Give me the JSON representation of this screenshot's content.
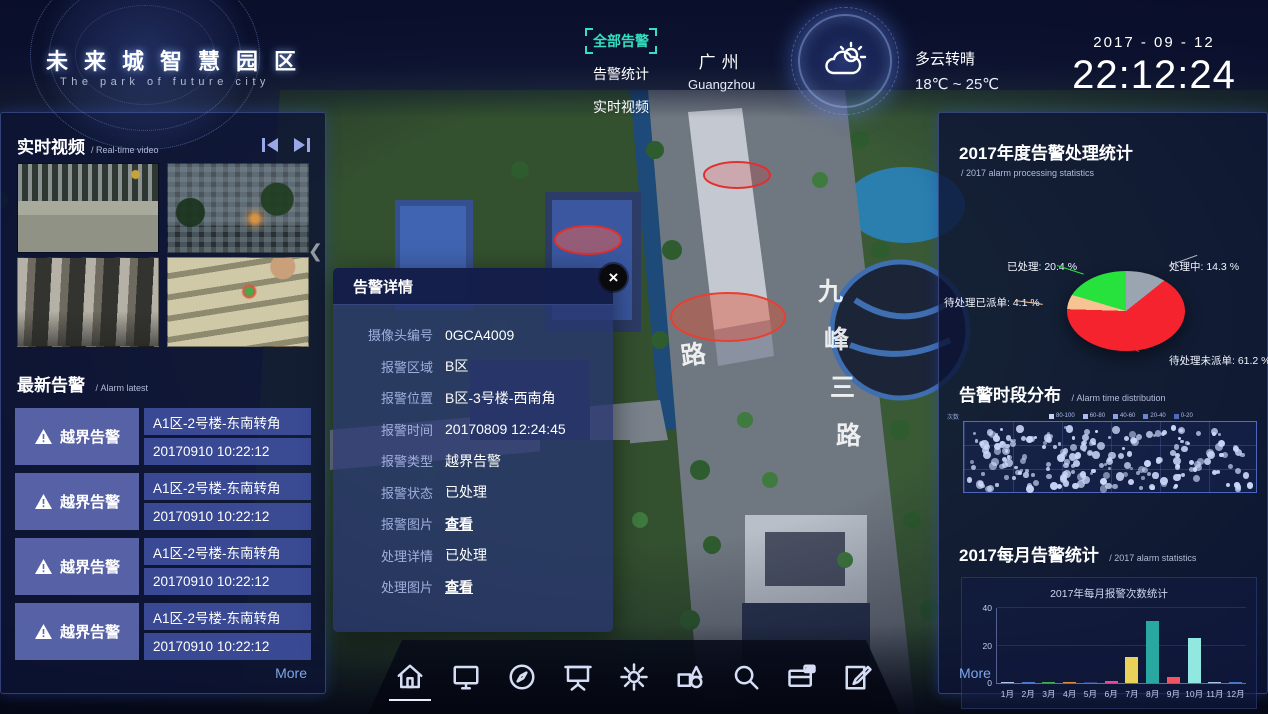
{
  "header": {
    "logo_title": "未来城智慧园区",
    "logo_subtitle": "The park of future city",
    "nav": [
      {
        "label": "全部告警",
        "active": true
      },
      {
        "label": "告警统计",
        "active": false
      },
      {
        "label": "实时视频",
        "active": false
      }
    ],
    "city_cn": "广州",
    "city_en": "Guangzhou",
    "weather_desc": "多云转晴",
    "weather_temp": "18℃ ~ 25℃",
    "date": "2017 - 09 - 12",
    "time": "22:12:24"
  },
  "left_panel": {
    "video_title": "实时视频",
    "video_subtitle": "/ Real-time video",
    "videos": [
      "street-crosswalk",
      "building-dusk",
      "lobby-interior",
      "stairs-closeup"
    ],
    "alarm_title": "最新告警",
    "alarm_subtitle": "/ Alarm latest",
    "alarms": [
      {
        "type": "越界告警",
        "location": "A1区-2号楼-东南转角",
        "time": "20170910 10:22:12"
      },
      {
        "type": "越界告警",
        "location": "A1区-2号楼-东南转角",
        "time": "20170910 10:22:12"
      },
      {
        "type": "越界告警",
        "location": "A1区-2号楼-东南转角",
        "time": "20170910 10:22:12"
      },
      {
        "type": "越界告警",
        "location": "A1区-2号楼-东南转角",
        "time": "20170910 10:22:12"
      }
    ],
    "more_label": "More"
  },
  "popup": {
    "title": "告警详情",
    "close_glyph": "×",
    "rows": [
      {
        "label": "摄像头编号",
        "value": "0GCA4009",
        "link": false
      },
      {
        "label": "报警区域",
        "value": "B区",
        "link": false
      },
      {
        "label": "报警位置",
        "value": "B区-3号楼-西南角",
        "link": false
      },
      {
        "label": "报警时间",
        "value": "20170809 12:24:45",
        "link": false
      },
      {
        "label": "报警类型",
        "value": "越界告警",
        "link": false
      },
      {
        "label": "报警状态",
        "value": "已处理",
        "link": false
      },
      {
        "label": "报警图片",
        "value": "查看",
        "link": true
      },
      {
        "label": "处理详情",
        "value": "已处理",
        "link": false
      },
      {
        "label": "处理图片",
        "value": "查看",
        "link": true
      }
    ]
  },
  "right_panel": {
    "more_label": "More"
  },
  "chart_data": [
    {
      "type": "pie",
      "title": "2017年度告警处理统计",
      "subtitle": "/ 2017 alarm processing statistics",
      "start": "top",
      "direction": "clockwise",
      "label_format": "{label}: {value} %",
      "slices": [
        {
          "label": "处理中",
          "value": 14.3,
          "color": "#9aa5b1",
          "css": "doing"
        },
        {
          "label": "待处理未派单",
          "value": 61.2,
          "color": "#f5232e",
          "css": "unsent"
        },
        {
          "label": "待处理已派单",
          "value": 4.1,
          "color": "#f8c393",
          "css": "sent"
        },
        {
          "label": "已处理",
          "value": 20.4,
          "color": "#27e23c",
          "css": "done"
        }
      ]
    },
    {
      "type": "scatter",
      "title": "告警时段分布",
      "subtitle": "/ Alarm time distribution",
      "axis_label": "次数",
      "legend": [
        {
          "label": "80-100",
          "color": "#c6d2f8"
        },
        {
          "label": "60-80",
          "color": "#a9bbf0"
        },
        {
          "label": "40-60",
          "color": "#8ba1e4"
        },
        {
          "label": "20-40",
          "color": "#6d86d4"
        },
        {
          "label": "0-20",
          "color": "#5069ba"
        }
      ],
      "appearance": "dense random dot field over 6x3 grid",
      "generator": {
        "seed": 20170912,
        "count": 215
      }
    },
    {
      "type": "bar",
      "title": "2017每月告警统计",
      "subtitle": "/ 2017 alarm statistics",
      "inner_title": "2017年每月报警次数统计",
      "categories": [
        "1月",
        "2月",
        "3月",
        "4月",
        "5月",
        "6月",
        "7月",
        "8月",
        "9月",
        "10月",
        "11月",
        "12月"
      ],
      "values": [
        0.6,
        0.6,
        0.7,
        0.7,
        0.6,
        1,
        14,
        33,
        3,
        24,
        0.6,
        0.3
      ],
      "colors": [
        "#aac4e8",
        "#4a78c8",
        "#3fae4a",
        "#e08a3c",
        "#2a3f7a",
        "#e84a9a",
        "#e8d25a",
        "#28a8a0",
        "#f05560",
        "#90e8e0",
        "#aac4e8",
        "#4a78c8"
      ],
      "ylim": [
        0,
        40
      ],
      "yticks": [
        0,
        20,
        40
      ]
    }
  ],
  "map": {
    "road_label_main": "九峰三路",
    "road_label_side": "路",
    "alarm_zone_count": 3
  },
  "toolbar": {
    "icons": [
      "home",
      "monitor",
      "compass",
      "projection-screen",
      "gear",
      "shapes",
      "search",
      "id-card",
      "edit"
    ],
    "active": "home"
  }
}
